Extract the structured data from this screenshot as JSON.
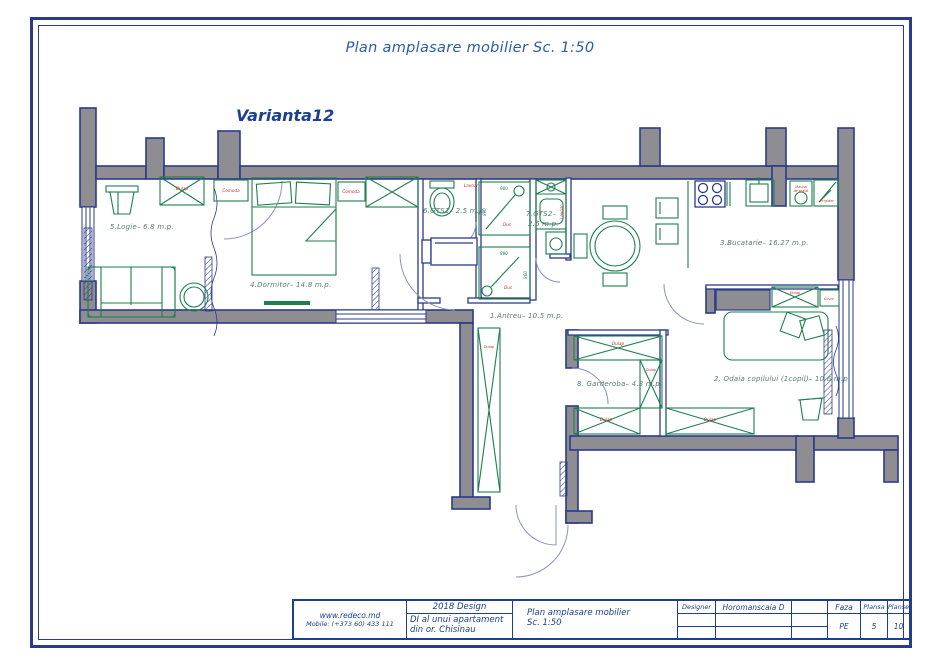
{
  "page": {
    "title": "Plan amplasare mobilier Sc. 1:50",
    "variant": "Varianta12"
  },
  "colors": {
    "frame_blue": "#2b3a8c",
    "title_blue": "#2b5ca8",
    "wall_gray": "#8d8d92",
    "furniture_green": "#1e7f4e",
    "annotation_red": "#c23127",
    "room_label_green": "#597f6d",
    "title_block_blue": "#1d3f8f"
  },
  "rooms": {
    "antreu": {
      "label": "1.Antreu– 10.5 m.p."
    },
    "odaia": {
      "label": "2. Odaia copilului (1copil)– 10.6 m.p."
    },
    "bucatarie": {
      "label": "3.Bucatarie– 16.27 m.p."
    },
    "dormitor": {
      "label": "4.Dormitor– 14.8 m.p."
    },
    "logie": {
      "label": "5.Logie– 6.8 m.p."
    },
    "gts1": {
      "label": "6.GTS1– 2.5 m.p."
    },
    "gts2": {
      "label": "7.GTS2–",
      "label2": "2.6 m.p."
    },
    "garderoba": {
      "label": "8. Garderoba– 4.3 m.p."
    }
  },
  "labels": {
    "dulap": "Dulap",
    "comoda": "Comoda",
    "lavoar": "Lavoar",
    "dus": "Dus",
    "frigider": "Frigider",
    "covor": "Covor",
    "masina_line1": "Masina",
    "masina_line2": "de spalat"
  },
  "dims": {
    "shower1_w": "900",
    "shower1_h": "890",
    "shower2_w": "880",
    "shower2_h": "860"
  },
  "title_block": {
    "website": "www.redeco.md",
    "phone": "Mobile: (+373 60) 433 111",
    "year_design": "2018 Design",
    "project_line1": "DI al unui apartament",
    "project_line2": "din or. Chisinau",
    "drawing_title_line1": "Plan amplasare mobilier",
    "drawing_title_line2": "Sc. 1:50",
    "designer_label": "Designer",
    "designer_name": "Horomanscaia D",
    "faza_label": "Faza",
    "faza_value": "PE",
    "plansa_label": "Plansa",
    "plansa_value": "5",
    "planse_label": "Planse",
    "planse_value": "10"
  }
}
